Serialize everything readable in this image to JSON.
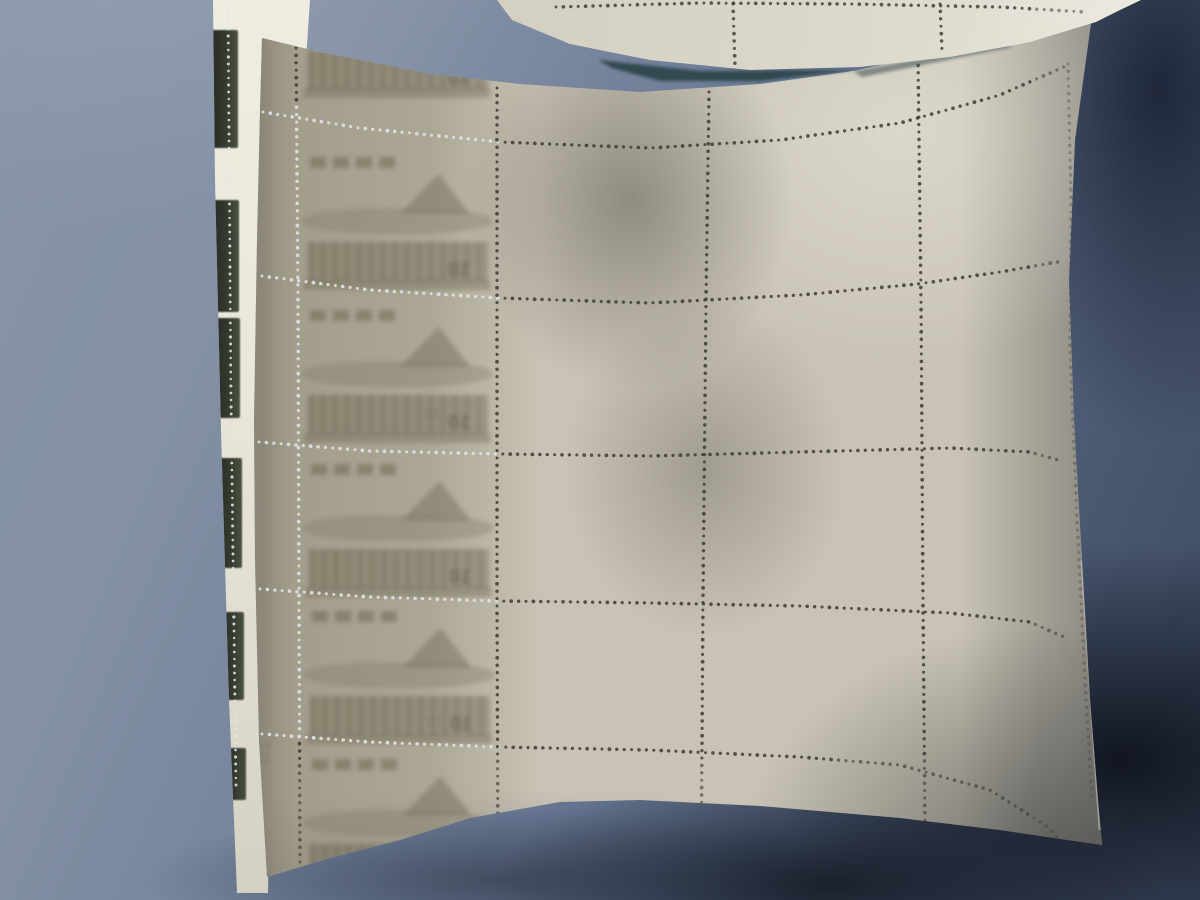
{
  "scene": {
    "description": "Photograph of the back of a cream postage-stamp sheet with punched perforation dot grid, lying over another sheet, on a blue-gray surface with strong shadows",
    "denomination": "10",
    "mirrored_denomination": "01",
    "palette": {
      "background_light": "#8794a8",
      "background_dark": "#3c485f",
      "sheet_base": "#c8c3b4",
      "sheet_bright": "#eeebe2",
      "left_column_olive": "#a49d8c",
      "under_sheet_white": "#efede1",
      "fragment_dark": "#1c211a",
      "perf_dot_dark": "#39362e",
      "perf_dot_light": "#dfe3e6",
      "gap_shadow": "#2c4347"
    },
    "under_sheet": {
      "fragments": [
        {
          "x": 211,
          "y": 30,
          "w": 27,
          "h": 118
        },
        {
          "x": 213,
          "y": 200,
          "w": 26,
          "h": 112
        },
        {
          "x": 215,
          "y": 318,
          "w": 25,
          "h": 100
        },
        {
          "x": 217,
          "y": 458,
          "w": 25,
          "h": 110
        },
        {
          "x": 220,
          "y": 612,
          "w": 24,
          "h": 88
        },
        {
          "x": 223,
          "y": 748,
          "w": 23,
          "h": 52
        }
      ],
      "perf_col": {
        "pts": [
          [
            228,
            8
          ],
          [
            231,
            400
          ],
          [
            236,
            786
          ]
        ]
      }
    },
    "main_sheet": {
      "perf_rows": [
        {
          "pts": [
            [
              263,
              112
            ],
            [
              360,
              128
            ],
            [
              500,
              142
            ],
            [
              650,
              148
            ],
            [
              780,
              140
            ],
            [
              900,
              123
            ],
            [
              1000,
              95
            ],
            [
              1066,
              66
            ]
          ],
          "light_until": 500
        },
        {
          "pts": [
            [
              262,
              276
            ],
            [
              370,
              290
            ],
            [
              500,
              298
            ],
            [
              650,
              303
            ],
            [
              800,
              295
            ],
            [
              918,
              284
            ],
            [
              1000,
              272
            ],
            [
              1063,
              261
            ]
          ],
          "light_until": 500
        },
        {
          "pts": [
            [
              259,
              442
            ],
            [
              370,
              451
            ],
            [
              500,
              454
            ],
            [
              650,
              456
            ],
            [
              800,
              452
            ],
            [
              950,
              448
            ],
            [
              1030,
              452
            ],
            [
              1062,
              461
            ]
          ],
          "light_until": 500
        },
        {
          "pts": [
            [
              260,
              589
            ],
            [
              370,
              597
            ],
            [
              500,
              601
            ],
            [
              650,
              603
            ],
            [
              800,
              606
            ],
            [
              950,
              613
            ],
            [
              1030,
              622
            ],
            [
              1066,
              638
            ]
          ],
          "light_until": 500
        },
        {
          "pts": [
            [
              262,
              734
            ],
            [
              370,
              742
            ],
            [
              500,
              747
            ],
            [
              650,
              750
            ],
            [
              800,
              757
            ],
            [
              900,
              765
            ],
            [
              990,
              790
            ],
            [
              1045,
              825
            ],
            [
              1068,
              848
            ]
          ],
          "light_until": 500
        }
      ],
      "perf_cols": [
        {
          "pts": [
            [
              296,
              48
            ],
            [
              298,
              300
            ],
            [
              299,
              600
            ],
            [
              300,
              874
            ]
          ],
          "light_y": [
            105,
            740
          ]
        },
        {
          "pts": [
            [
              497,
              88
            ],
            [
              497,
              300
            ],
            [
              497,
              600
            ],
            [
              498,
              882
            ]
          ]
        },
        {
          "pts": [
            [
              709,
              92
            ],
            [
              706,
              300
            ],
            [
              703,
              600
            ],
            [
              701,
              886
            ]
          ]
        },
        {
          "pts": [
            [
              918,
              58
            ],
            [
              921,
              300
            ],
            [
              923,
              600
            ],
            [
              925,
              824
            ]
          ]
        },
        {
          "pts": [
            [
              1068,
              64
            ],
            [
              1071,
              200
            ],
            [
              1070,
              350
            ],
            [
              1077,
              520
            ],
            [
              1085,
              680
            ],
            [
              1092,
              798
            ]
          ],
          "edge": true
        }
      ],
      "stamp_cells": [
        {
          "x": 300,
          "y": -42,
          "partial": "top"
        },
        {
          "x": 300,
          "y": 150
        },
        {
          "x": 300,
          "y": 303
        },
        {
          "x": 301,
          "y": 457
        },
        {
          "x": 302,
          "y": 604
        },
        {
          "x": 302,
          "y": 752,
          "partial": "bottom"
        }
      ],
      "cell_w": 195,
      "cell_h": 148,
      "ghost_marks": [
        {
          "x": 250,
          "y": 740,
          "size": 24,
          "rot": 90,
          "opacity": 0.16
        },
        {
          "x": 424,
          "y": 406,
          "size": 15,
          "rot": 0,
          "opacity": 0.18
        },
        {
          "x": 427,
          "y": 714,
          "size": 15,
          "rot": 0,
          "opacity": 0.16
        }
      ]
    },
    "top_sheet": {
      "perf_rows": [
        {
          "pts": [
            [
              556,
              7
            ],
            [
              700,
              3
            ],
            [
              850,
              4
            ],
            [
              1000,
              7
            ],
            [
              1085,
              12
            ]
          ]
        }
      ],
      "perf_cols": [
        {
          "pts": [
            [
              733,
              4
            ],
            [
              735,
              66
            ]
          ]
        },
        {
          "pts": [
            [
              940,
              4
            ],
            [
              942,
              50
            ]
          ]
        }
      ]
    },
    "gap_shadows": [
      {
        "points": "598,60 700,71 856,70 760,81 660,81 612,68",
        "fill": "#2c4347",
        "opacity": 0.9
      },
      {
        "points": "853,71 1005,44 1012,47 862,77",
        "fill": "#3a4a50",
        "opacity": 0.55
      }
    ]
  }
}
